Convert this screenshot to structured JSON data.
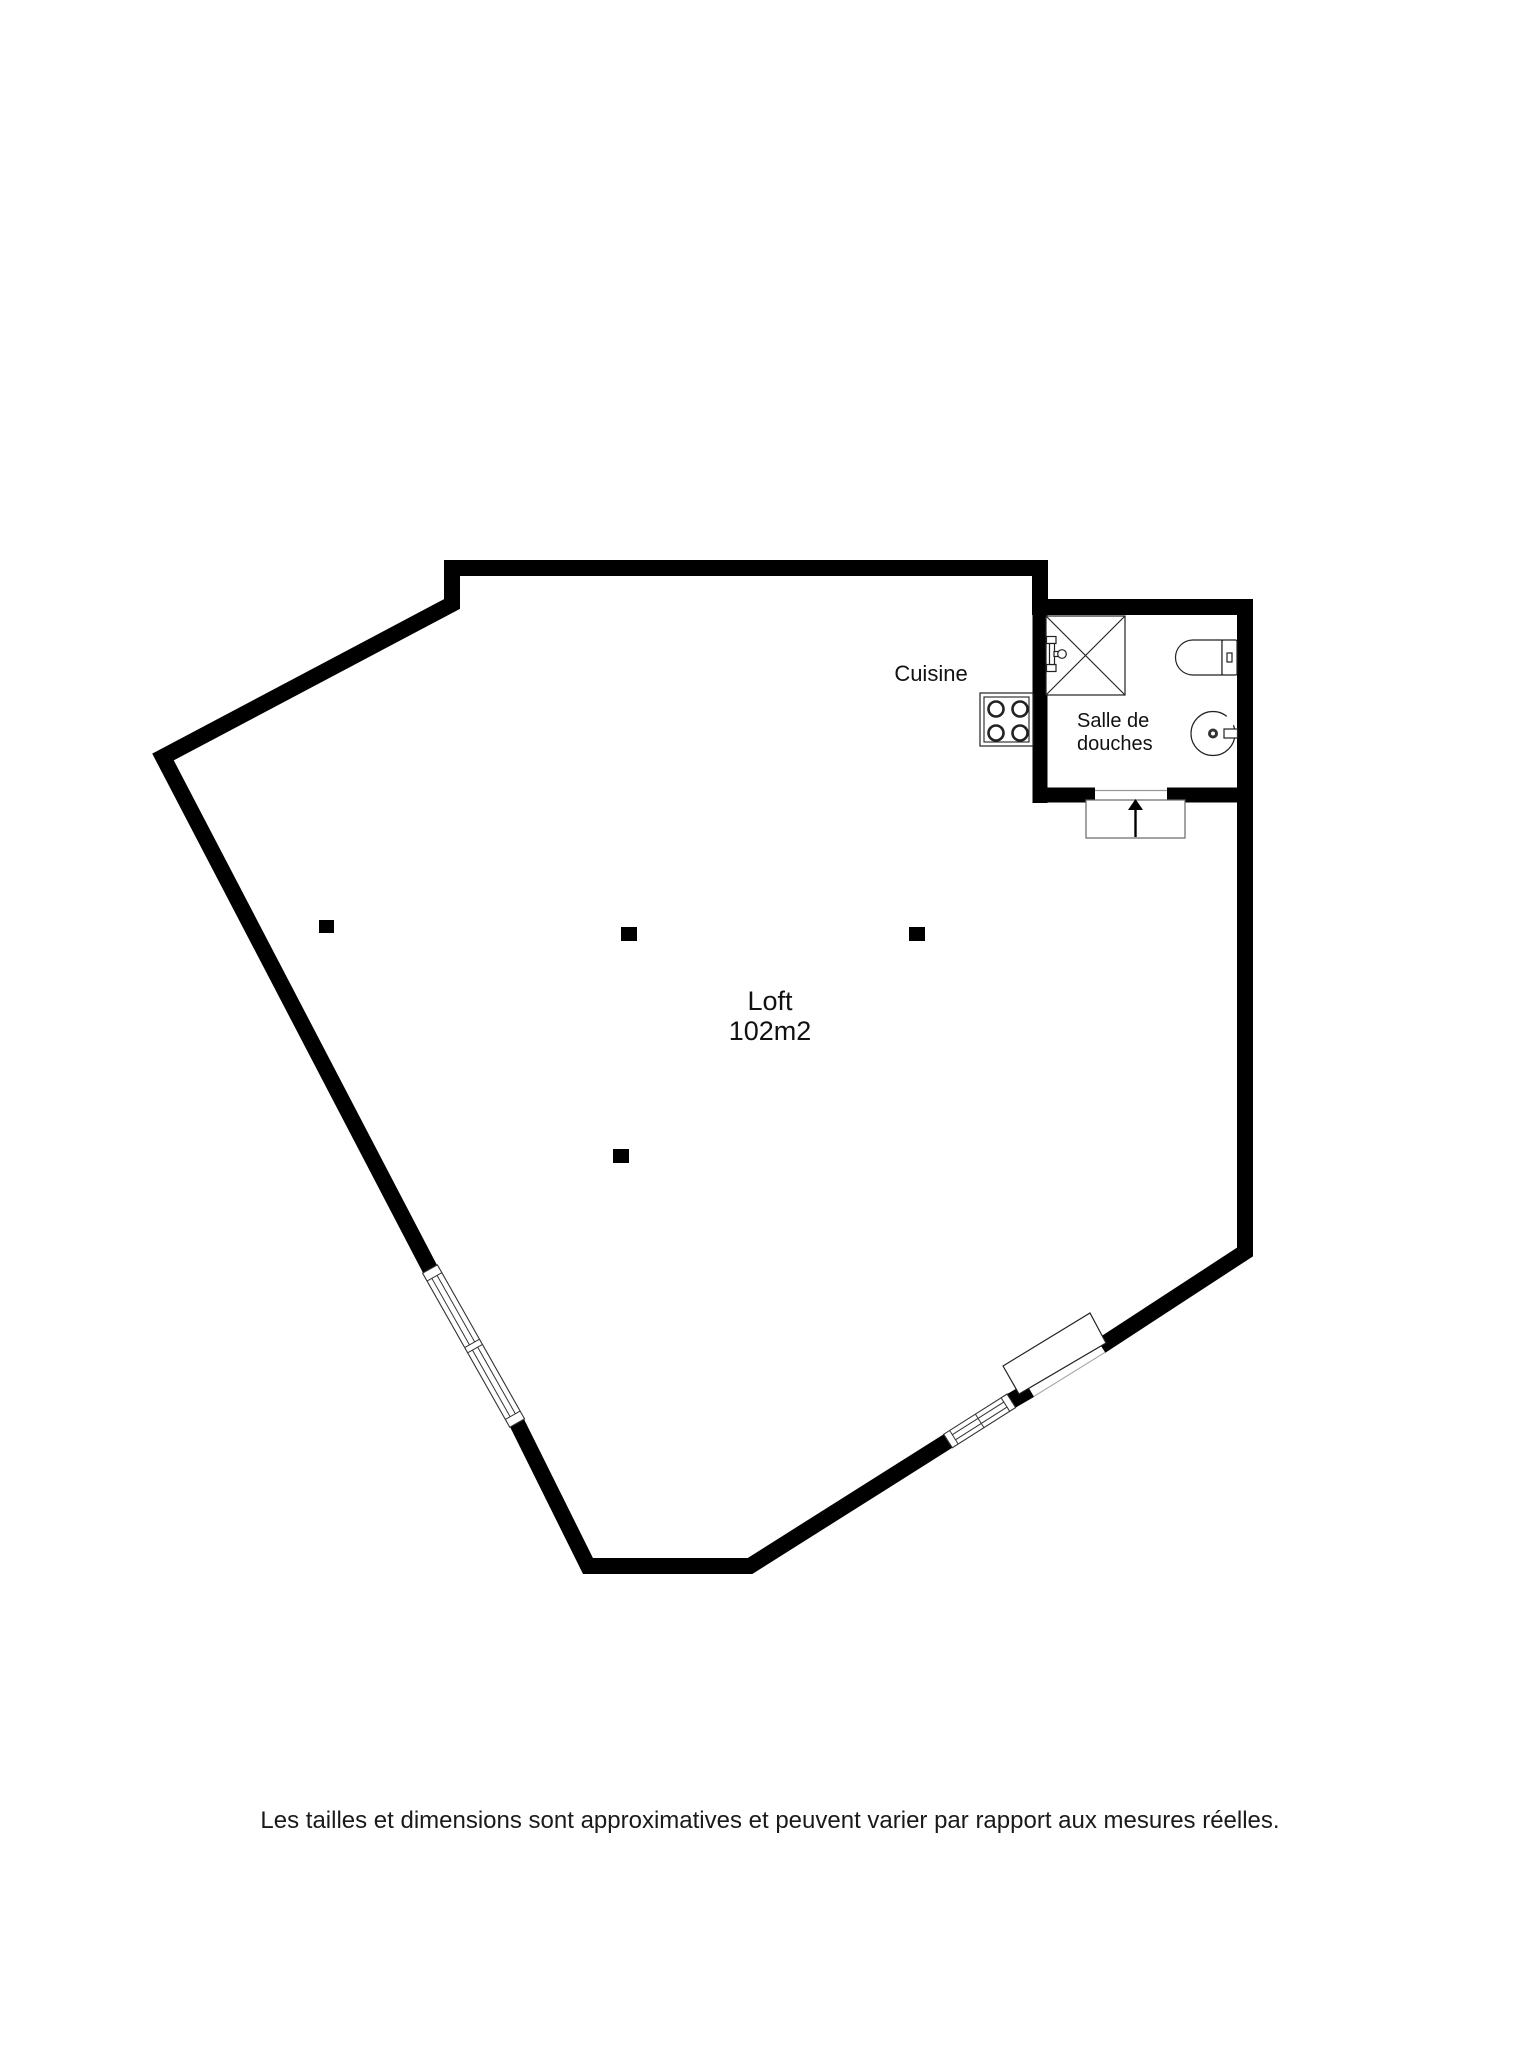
{
  "colors": {
    "background": "#ffffff",
    "wall": "#000000",
    "fixture_stroke": "#222222",
    "text": "#111111"
  },
  "floorplan": {
    "loft": {
      "name": "Loft",
      "area": "102m2"
    },
    "kitchen": {
      "label": "Cuisine"
    },
    "shower_room": {
      "line1": "Salle de",
      "line2": "douches"
    },
    "icons": {
      "shower": "shower-icon",
      "toilet": "toilet-icon",
      "sink": "sink-icon",
      "stove": "stove-icon",
      "window": "window-icon",
      "door": "door-icon",
      "entrance_arrow": "entrance-arrow-icon",
      "pillar": "pillar-icon"
    }
  },
  "footer": {
    "disclaimer": "Les tailles et dimensions sont approximatives et peuvent varier par rapport aux mesures réelles."
  }
}
